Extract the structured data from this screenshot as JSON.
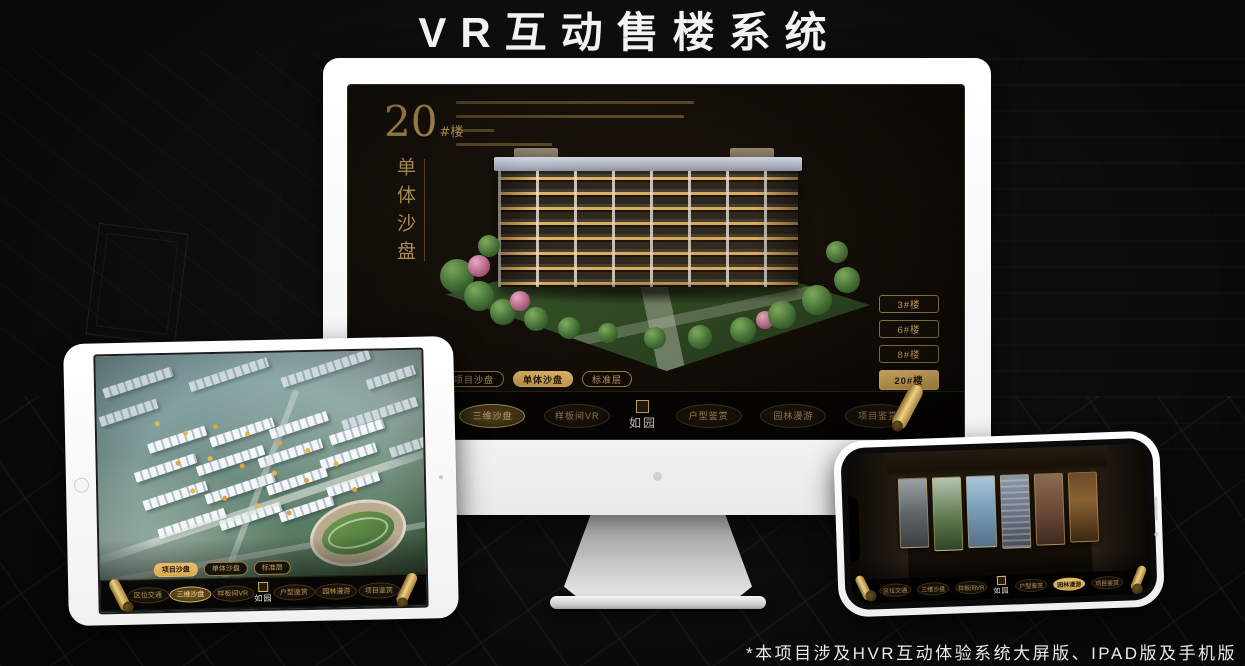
{
  "title": "VR互动售楼系统",
  "footnote": "*本项目涉及HVR互动体验系统大屏版、IPAD版及手机版",
  "colors": {
    "gold": "#c9a25f",
    "gold_active": "#e3b765",
    "screen_bg": "#15100a",
    "title_color": "#f2f2f2"
  },
  "monitor": {
    "headline": {
      "number": "20",
      "unit": "#楼",
      "subtitle_vertical": "单体沙盘"
    },
    "floor_buttons": [
      {
        "label": "3#楼",
        "active": false
      },
      {
        "label": "6#楼",
        "active": false
      },
      {
        "label": "8#楼",
        "active": false
      },
      {
        "label": "20#楼",
        "active": true
      }
    ],
    "sub_tabs": [
      {
        "label": "项目沙盘",
        "active": false
      },
      {
        "label": "单体沙盘",
        "active": true
      },
      {
        "label": "标准层",
        "active": false
      }
    ],
    "nav_items": [
      {
        "label": "区位交通",
        "active": false
      },
      {
        "label": "三维沙盘",
        "active": true
      },
      {
        "label": "样板间VR",
        "active": false
      },
      {
        "label": "户型鉴赏",
        "active": false
      },
      {
        "label": "园林漫游",
        "active": false
      },
      {
        "label": "项目鉴赏",
        "active": false
      }
    ],
    "logo": "如园"
  },
  "tablet": {
    "sub_tabs": [
      {
        "label": "项目沙盘",
        "active": true
      },
      {
        "label": "单体沙盘",
        "active": false
      },
      {
        "label": "标准层",
        "active": false
      }
    ],
    "nav_items": [
      {
        "label": "区位交通",
        "active": false
      },
      {
        "label": "三维沙盘",
        "active": true
      },
      {
        "label": "样板间VR",
        "active": false
      },
      {
        "label": "户型鉴赏",
        "active": false
      },
      {
        "label": "园林漫游",
        "active": false
      },
      {
        "label": "项目鉴赏",
        "active": false
      }
    ],
    "logo": "如园"
  },
  "phone": {
    "nav_items": [
      {
        "label": "区位交通",
        "active": false
      },
      {
        "label": "三维沙盘",
        "active": false
      },
      {
        "label": "样板间VR",
        "active": false
      },
      {
        "label": "户型鉴赏",
        "active": false
      },
      {
        "label": "园林漫游",
        "active": true
      },
      {
        "label": "项目鉴赏",
        "active": false
      }
    ],
    "logo": "如园"
  }
}
